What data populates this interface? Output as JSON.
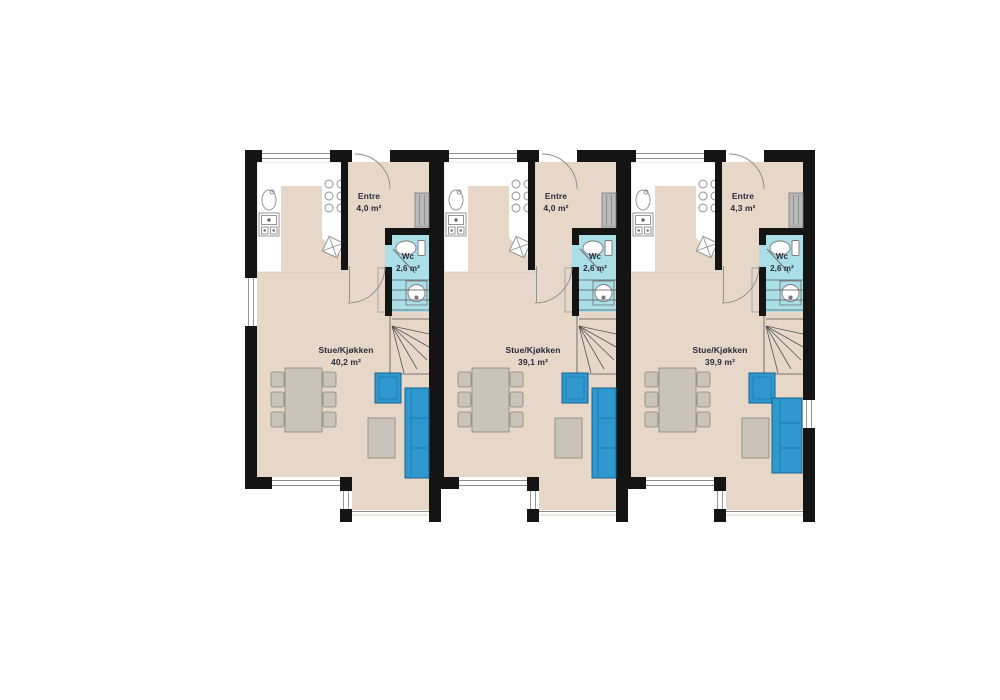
{
  "plan": {
    "type": "floor-plan",
    "units": [
      {
        "name": "unit-1",
        "entre": {
          "label": "Entre",
          "area": "4,0 m²"
        },
        "wc": {
          "label": "Wc",
          "area": "2,6 m²"
        },
        "living": {
          "label": "Stue/Kjøkken",
          "area": "40,2 m²"
        }
      },
      {
        "name": "unit-2",
        "entre": {
          "label": "Entre",
          "area": "4,0 m²"
        },
        "wc": {
          "label": "Wc",
          "area": "2,6 m²"
        },
        "living": {
          "label": "Stue/Kjøkken",
          "area": "39,1 m²"
        }
      },
      {
        "name": "unit-3",
        "entre": {
          "label": "Entre",
          "area": "4,3 m²"
        },
        "wc": {
          "label": "Wc",
          "area": "2,6 m²"
        },
        "living": {
          "label": "Stue/Kjøkken",
          "area": "39,9 m²"
        }
      }
    ],
    "colors": {
      "wall": "#141414",
      "floor_tan": "#e6d7c8",
      "wc_floor": "#abdfe8",
      "furniture_blue": "#2f99cf",
      "furniture_blue_border": "#16628d",
      "furniture_gray": "#c9c3b9",
      "furniture_gray_border": "#8a8478",
      "fixture_stroke": "#8a8a8a",
      "window_frame": "#8c8c8c",
      "stair_line": "#555555"
    }
  }
}
